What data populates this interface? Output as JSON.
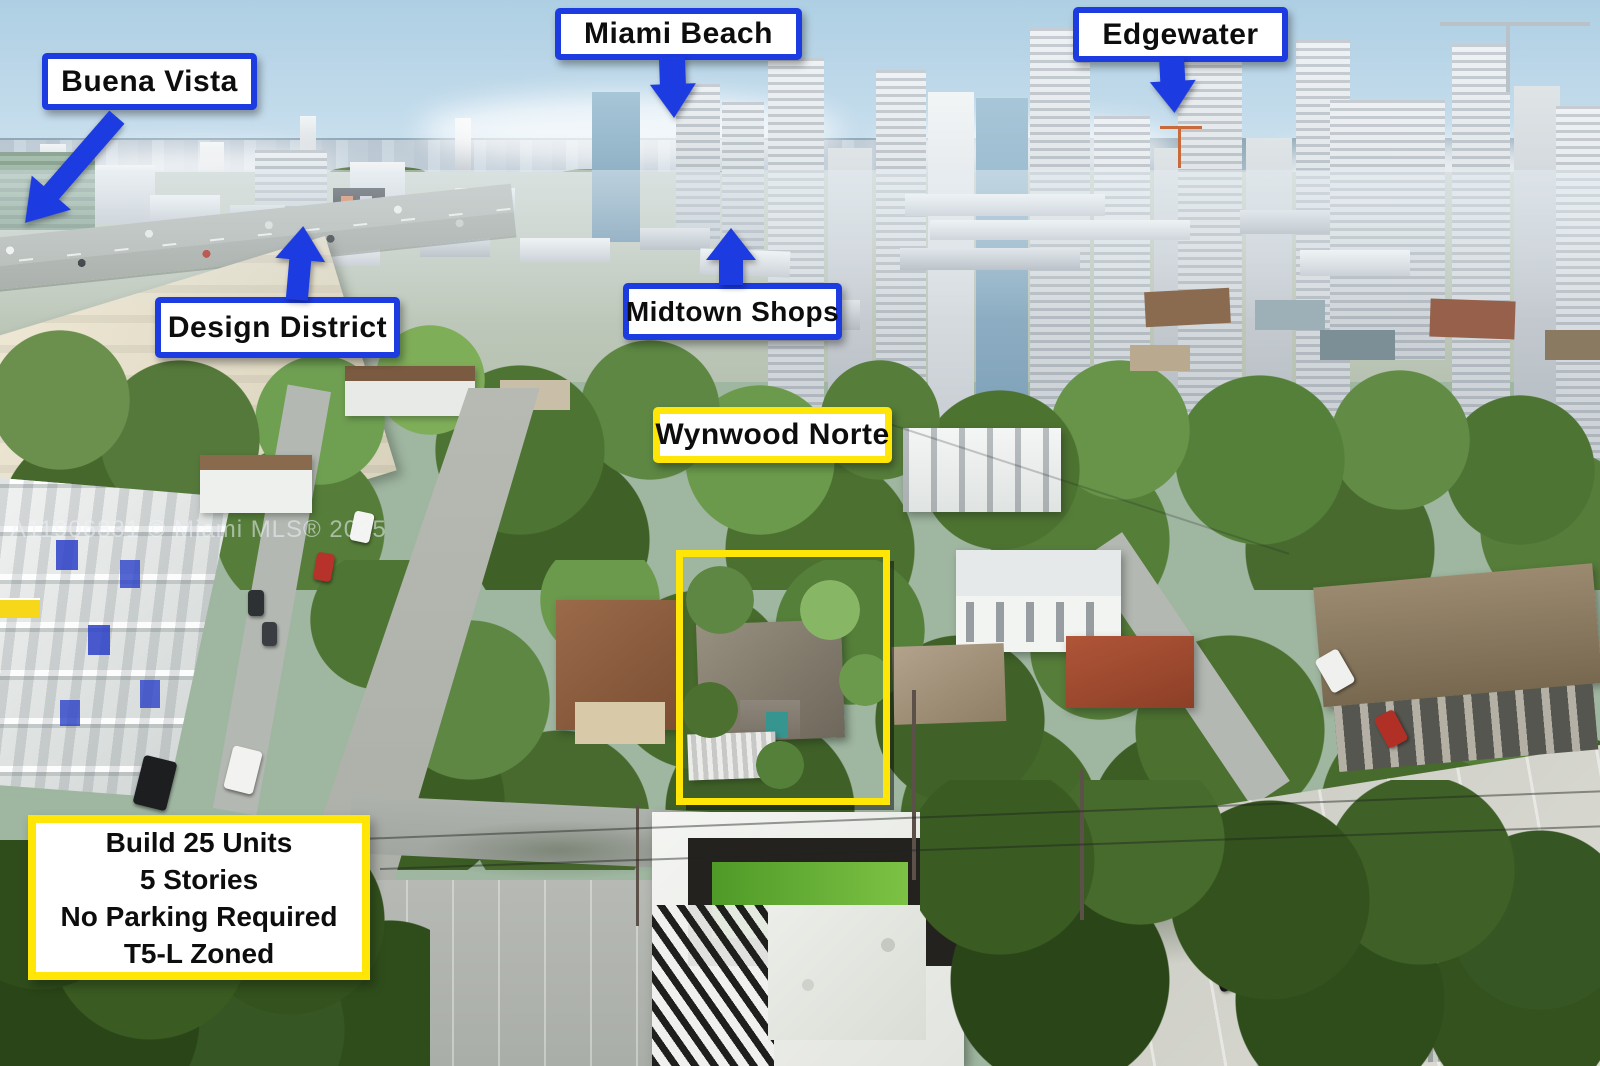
{
  "annotations": {
    "labels": [
      {
        "id": "buena-vista",
        "text": "Buena Vista",
        "arrow": "down-left"
      },
      {
        "id": "miami-beach",
        "text": "Miami Beach",
        "arrow": "down"
      },
      {
        "id": "edgewater",
        "text": "Edgewater",
        "arrow": "down"
      },
      {
        "id": "design-district",
        "text": "Design District",
        "arrow": "up"
      },
      {
        "id": "midtown-shops",
        "text": "Midtown Shops",
        "arrow": "up"
      },
      {
        "id": "wynwood-norte",
        "text": "Wynwood Norte",
        "arrow": "none"
      }
    ],
    "info_box": {
      "lines": [
        "Build 25 Units",
        "5 Stories",
        "No Parking Required",
        "T5-L Zoned"
      ]
    },
    "watermark": "A11906831 © Miami MLS® 2025",
    "colors": {
      "label_border_blue": "#1c3be0",
      "highlight_yellow": "#ffe607",
      "label_background": "#ffffff",
      "label_text": "#0d0d0d"
    }
  }
}
